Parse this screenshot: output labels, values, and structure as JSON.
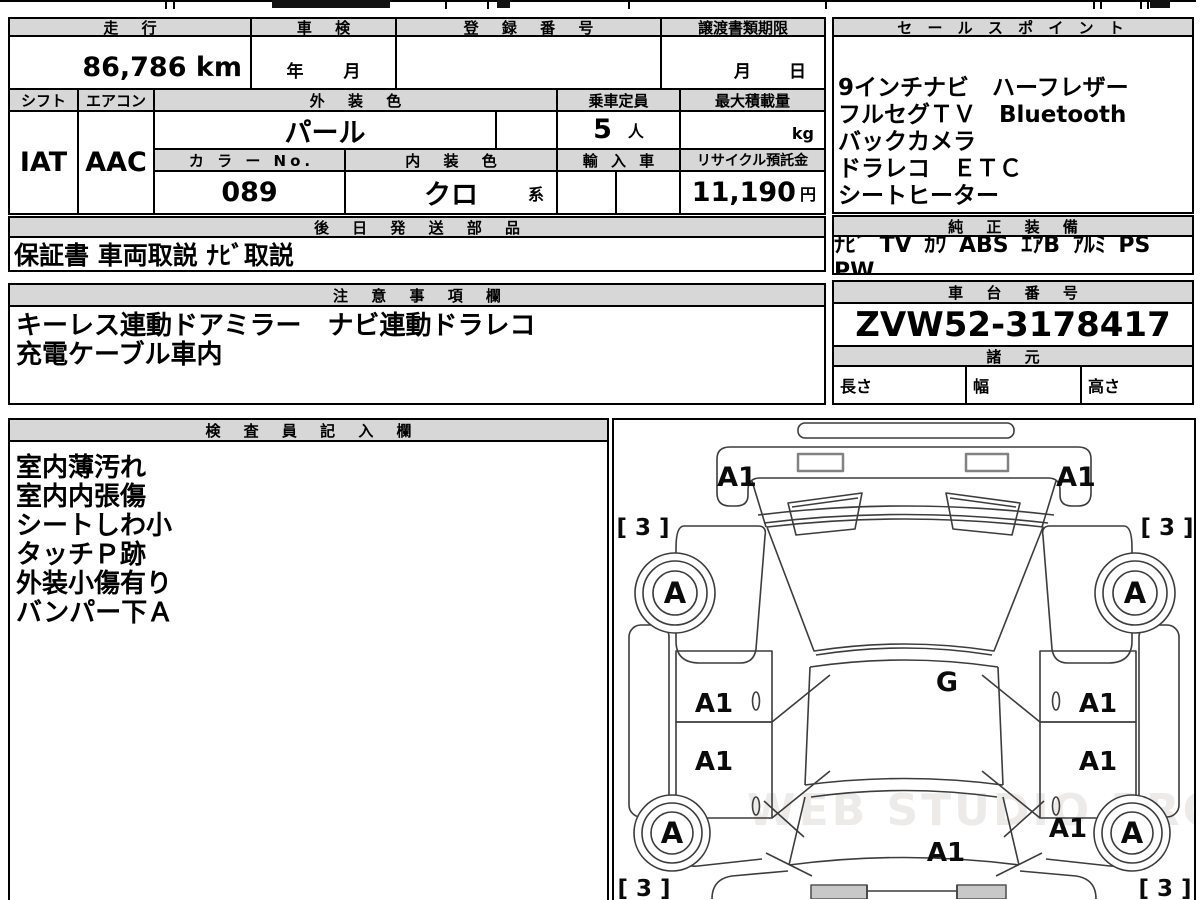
{
  "vehicle": {
    "mileage_label": "走 行",
    "mileage_value": "86,786 km",
    "shaken_label": "車 検",
    "shaken_year_unit": "年",
    "shaken_month_unit": "月",
    "registration_label": "登 録 番 号",
    "transfer_label": "譲渡書類期限",
    "transfer_month_unit": "月",
    "transfer_day_unit": "日",
    "shift_label": "シフト",
    "shift_value": "IAT",
    "aircon_label": "エアコン",
    "aircon_value": "AAC",
    "exterior_color_label": "外 装 色",
    "exterior_color_value": "パール",
    "capacity_label": "乗車定員",
    "capacity_value": "5",
    "capacity_unit": "人",
    "max_load_label": "最大積載量",
    "max_load_unit": "kg",
    "color_no_label": "カ ラ ー No.",
    "color_no_value": "089",
    "interior_color_label": "内 装 色",
    "interior_color_value": "クロ",
    "interior_color_suffix": "系",
    "import_label": "輸 入 車",
    "recycle_label": "リサイクル預託金",
    "recycle_value": "11,190",
    "recycle_unit": "円"
  },
  "sales_point": {
    "title": "セ ー ル ス ポ イ ン ト",
    "lines": [
      "9インチナビ　ハーフレザー",
      "フルセグＴＶ　Bluetooth",
      "バックカメラ",
      "ドラレコ　ＥＴＣ",
      "シートヒーター"
    ]
  },
  "shipping": {
    "title": "後 日 発 送 部 品",
    "value": "保証書 車両取説 ﾅﾋﾞ取説"
  },
  "equipment": {
    "title": "純 正 装 備",
    "value": "ﾅﾋﾞ TV ｶﾜ ABS ｴｱB ｱﾙﾐ PS PW"
  },
  "notes": {
    "title": "注 意 事 項 欄",
    "lines": [
      "キーレス連動ドアミラー　ナビ連動ドラレコ",
      "充電ケーブル車内"
    ]
  },
  "chassis": {
    "title": "車 台 番 号",
    "number": "ZVW52-3178417",
    "specs_title": "諸 元",
    "length_label": "長さ",
    "width_label": "幅",
    "height_label": "高さ"
  },
  "inspector": {
    "title": "検 査 員 記 入 欄",
    "lines": [
      "室内薄汚れ",
      "室内内張傷",
      "シートしわ小",
      "タッチＰ跡",
      "外装小傷有り",
      "バンパー下Ａ"
    ]
  },
  "diagram": {
    "labels": {
      "panel": "A1",
      "wheel": "A",
      "glass": "G",
      "tire": "[ 3 ]"
    },
    "watermark": "WEB STUDIO PRO"
  },
  "colors": {
    "header_bg": "#d7d7d7",
    "border": "#000000",
    "watermark": "#edebe9"
  }
}
